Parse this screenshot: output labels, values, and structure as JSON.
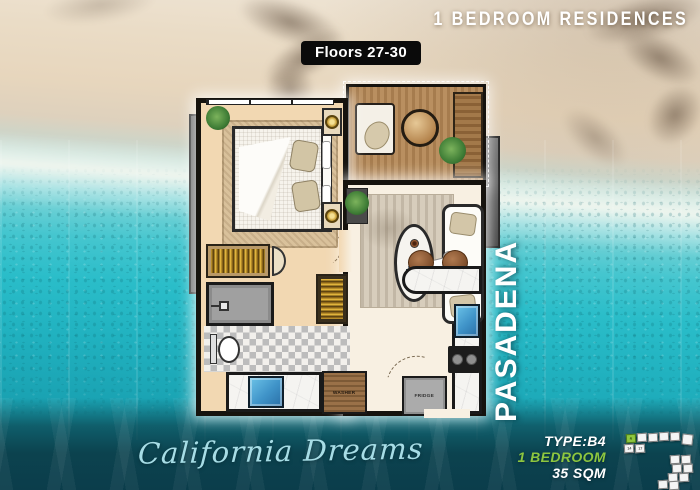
{
  "header": {
    "residences_title": "1 BEDROOM RESIDENCES",
    "floors_badge": "Floors 27-30"
  },
  "plan": {
    "building_name": "PASADENA",
    "washer_label": "WASHER",
    "fridge_label": "FRIDGE"
  },
  "footer": {
    "tagline": "California Dreams",
    "unit_type": "TYPE:B4",
    "unit_bedrooms": "1 BEDROOM",
    "unit_area": "35 SQM"
  },
  "keyplan": {
    "highlighted_unit": "4",
    "units": [
      "4",
      "",
      "",
      "",
      "",
      "",
      "14",
      "17",
      "",
      "",
      "",
      "",
      "",
      "",
      "",
      ""
    ]
  },
  "colors": {
    "accent_green": "#8dc63f",
    "water_turquoise": "#2abdc9",
    "sand_beige": "#eadcc6",
    "band_teal": "#0b3d4b",
    "plan_glow": "#ffffff"
  }
}
